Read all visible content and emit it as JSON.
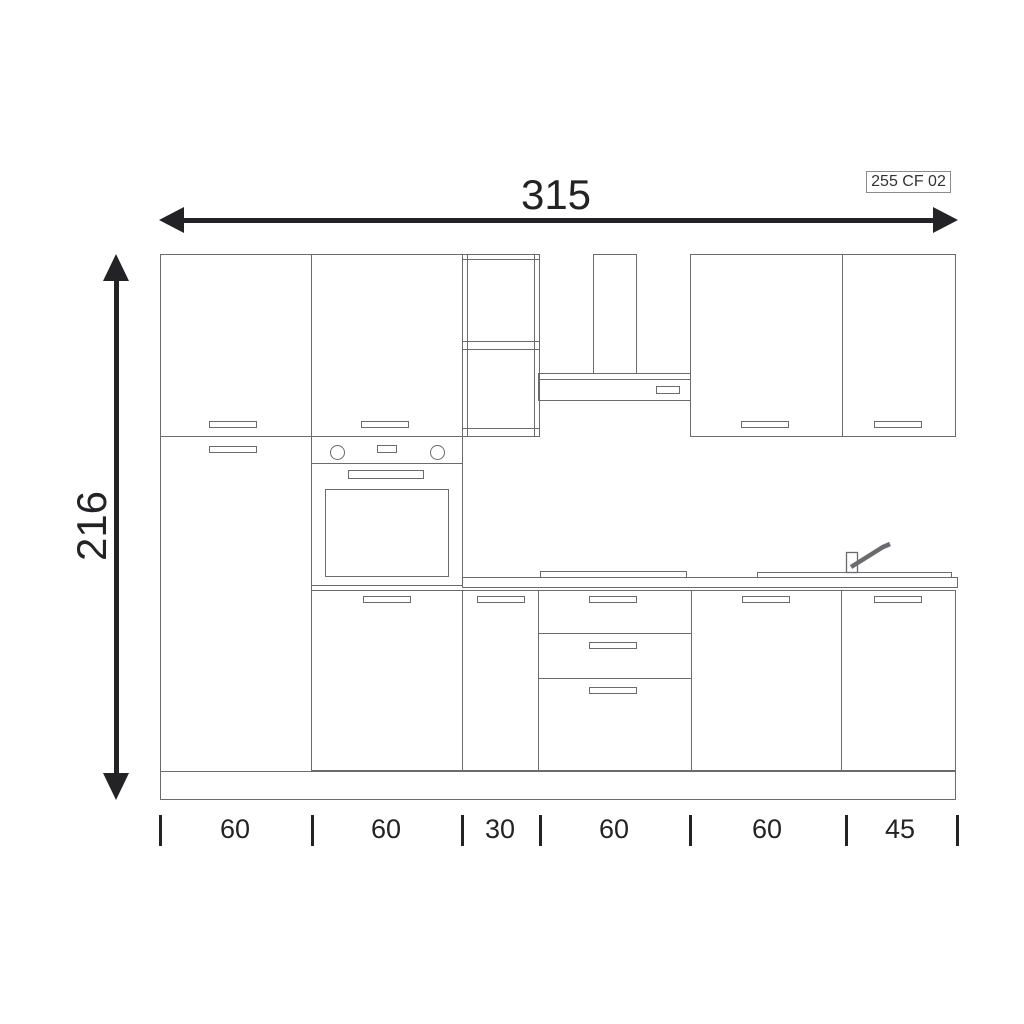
{
  "code_label": "255 CF 02",
  "dimensions": {
    "width_total": "315",
    "height_total": "216",
    "bottom_segments": [
      "60",
      "60",
      "30",
      "60",
      "60",
      "45"
    ]
  },
  "colors": {
    "cabinet_line": "#6a6a6f",
    "dimension": "#232326",
    "background": "#ffffff"
  }
}
